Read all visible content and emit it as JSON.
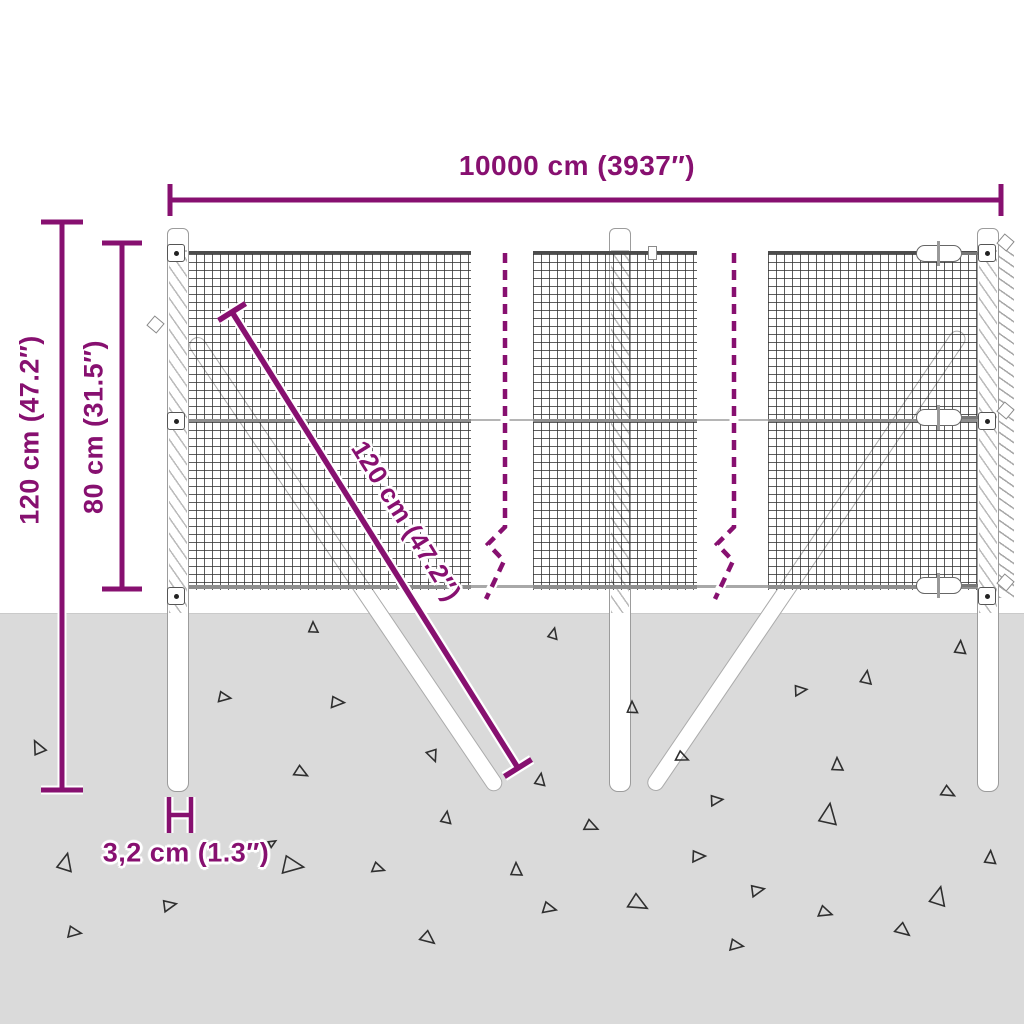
{
  "diagram": {
    "labels": {
      "total_width": "10000 cm (3937″)",
      "total_height": "120 cm (47.2″)",
      "mesh_height": "80 cm (31.5″)",
      "diagonal_length": "120 cm (47.2″)",
      "post_width": "3,2 cm (1.3″)"
    },
    "colors": {
      "accent": "#871070",
      "ground": "#dadada",
      "mesh_line": "#303030",
      "structure_outline": "#9c9c9c"
    }
  },
  "ground": {
    "triangles": [
      {
        "x": 313,
        "y": 628,
        "s": 10,
        "r": 0
      },
      {
        "x": 553,
        "y": 634,
        "s": 10,
        "r": 15
      },
      {
        "x": 38,
        "y": 748,
        "s": 13,
        "r": -25
      },
      {
        "x": 224,
        "y": 697,
        "s": 11,
        "r": 100
      },
      {
        "x": 337,
        "y": 702,
        "s": 12,
        "r": 95
      },
      {
        "x": 433,
        "y": 755,
        "s": 11,
        "r": 160
      },
      {
        "x": 301,
        "y": 772,
        "s": 12,
        "r": 120
      },
      {
        "x": 446,
        "y": 818,
        "s": 11,
        "r": 10
      },
      {
        "x": 65,
        "y": 863,
        "s": 16,
        "r": 15
      },
      {
        "x": 292,
        "y": 865,
        "s": 19,
        "r": 100
      },
      {
        "x": 378,
        "y": 868,
        "s": 11,
        "r": 110
      },
      {
        "x": 169,
        "y": 905,
        "s": 12,
        "r": 80
      },
      {
        "x": 74,
        "y": 932,
        "s": 12,
        "r": 100
      },
      {
        "x": 428,
        "y": 938,
        "s": 13,
        "r": 130
      },
      {
        "x": 632,
        "y": 708,
        "s": 11,
        "r": 0
      },
      {
        "x": 800,
        "y": 690,
        "s": 11,
        "r": 85
      },
      {
        "x": 866,
        "y": 678,
        "s": 12,
        "r": 10
      },
      {
        "x": 960,
        "y": 648,
        "s": 12,
        "r": 5
      },
      {
        "x": 682,
        "y": 757,
        "s": 11,
        "r": 115
      },
      {
        "x": 837,
        "y": 765,
        "s": 12,
        "r": 0
      },
      {
        "x": 540,
        "y": 780,
        "s": 11,
        "r": 10
      },
      {
        "x": 948,
        "y": 792,
        "s": 12,
        "r": 120
      },
      {
        "x": 716,
        "y": 800,
        "s": 11,
        "r": 85
      },
      {
        "x": 591,
        "y": 826,
        "s": 12,
        "r": 115
      },
      {
        "x": 828,
        "y": 815,
        "s": 19,
        "r": 10
      },
      {
        "x": 698,
        "y": 856,
        "s": 12,
        "r": 90
      },
      {
        "x": 990,
        "y": 858,
        "s": 12,
        "r": 5
      },
      {
        "x": 516,
        "y": 870,
        "s": 12,
        "r": 0
      },
      {
        "x": 757,
        "y": 890,
        "s": 12,
        "r": 80
      },
      {
        "x": 638,
        "y": 903,
        "s": 17,
        "r": 120
      },
      {
        "x": 938,
        "y": 897,
        "s": 17,
        "r": 15
      },
      {
        "x": 549,
        "y": 908,
        "s": 12,
        "r": 105
      },
      {
        "x": 825,
        "y": 912,
        "s": 12,
        "r": 110
      },
      {
        "x": 903,
        "y": 930,
        "s": 13,
        "r": 130
      },
      {
        "x": 736,
        "y": 945,
        "s": 12,
        "r": 100
      },
      {
        "x": 272,
        "y": 843,
        "s": 7,
        "r": 60
      }
    ]
  }
}
